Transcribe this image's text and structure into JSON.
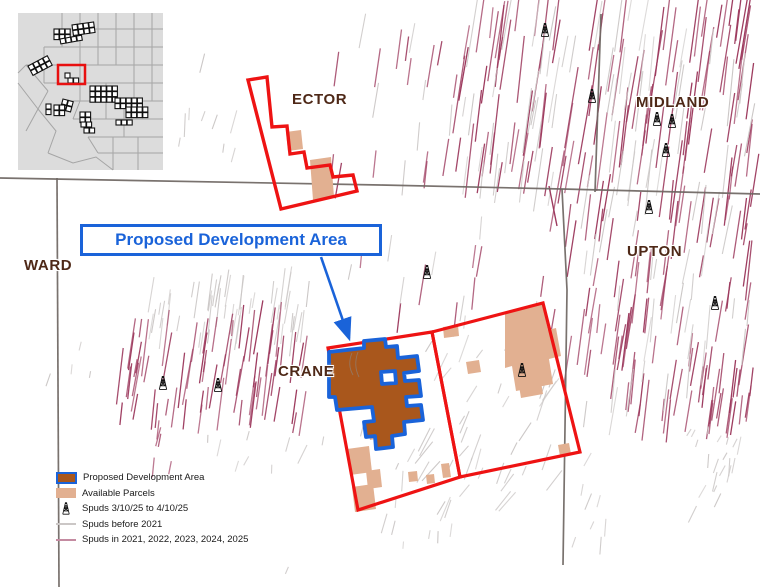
{
  "callout": {
    "label": "Proposed Development Area"
  },
  "county_labels": [
    {
      "id": "ector",
      "text": "ECTOR",
      "x": 292,
      "y": 91
    },
    {
      "id": "midland",
      "text": "MIDLAND",
      "x": 636,
      "y": 94
    },
    {
      "id": "upton",
      "text": "UPTON",
      "x": 627,
      "y": 243
    },
    {
      "id": "ward",
      "text": "WARD",
      "x": 24,
      "y": 257
    },
    {
      "id": "crane",
      "text": "CRANE",
      "x": 278,
      "y": 363
    }
  ],
  "legend": {
    "items": [
      {
        "swatch": "proposed",
        "label": "Proposed Development Area"
      },
      {
        "swatch": "parcel",
        "label": "Available Parcels"
      },
      {
        "swatch": "derrick",
        "label": "Spuds 3/10/25 to 4/10/25"
      },
      {
        "swatch": "line-gray",
        "label": "Spuds before 2021"
      },
      {
        "swatch": "line-pink",
        "label": "Spuds in 2021, 2022, 2023, 2024, 2025"
      }
    ]
  },
  "colors": {
    "red": "#ee1313",
    "blue": "#1a63d9",
    "brown": "#a9571c",
    "tan": "#e2b091",
    "maroon": "#9d3a5e",
    "gray_spud": "#cbc7c6",
    "county_line": "#6e6662",
    "label": "#4e2817",
    "inset_bg": "#dcdcdc",
    "inset_line": "#a5a5a5"
  },
  "map": {
    "county_lines": [
      [
        [
          0,
          178
        ],
        [
          380,
          185
        ],
        [
          562,
          189
        ],
        [
          760,
          194
        ]
      ],
      [
        [
          57,
          178
        ],
        [
          59,
          587
        ]
      ],
      [
        [
          562,
          189
        ],
        [
          567,
          290
        ],
        [
          563,
          565
        ]
      ],
      [
        [
          601,
          14
        ],
        [
          595,
          192
        ]
      ]
    ],
    "spud_clusters": [
      {
        "x": 455,
        "y": 0,
        "w": 300,
        "h": 192,
        "n": 105,
        "c": "maroon",
        "l": [
          30,
          85
        ],
        "tilt": 8,
        "tv": 4
      },
      {
        "x": 465,
        "y": 0,
        "w": 290,
        "h": 192,
        "n": 55,
        "c": "gray",
        "l": [
          25,
          75
        ],
        "tilt": 8,
        "tv": 6
      },
      {
        "x": 567,
        "y": 196,
        "w": 190,
        "h": 225,
        "n": 85,
        "c": "maroon",
        "l": [
          22,
          65
        ],
        "tilt": 8,
        "tv": 5
      },
      {
        "x": 585,
        "y": 200,
        "w": 172,
        "h": 215,
        "n": 34,
        "c": "gray",
        "l": [
          18,
          55
        ],
        "tilt": 8,
        "tv": 8
      },
      {
        "x": 700,
        "y": 372,
        "w": 52,
        "h": 48,
        "n": 14,
        "c": "maroon",
        "l": [
          25,
          45
        ],
        "tilt": 8,
        "tv": 4
      },
      {
        "x": 688,
        "y": 430,
        "w": 70,
        "h": 85,
        "n": 20,
        "c": "gray",
        "l": [
          7,
          20
        ],
        "tilt": 20,
        "tv": 40
      },
      {
        "x": 572,
        "y": 450,
        "w": 40,
        "h": 100,
        "n": 8,
        "c": "gray",
        "l": [
          7,
          18
        ],
        "tilt": 15,
        "tv": 30
      },
      {
        "x": 150,
        "y": 283,
        "w": 160,
        "h": 58,
        "n": 50,
        "c": "gray",
        "l": [
          12,
          42
        ],
        "tilt": 8,
        "tv": 5
      },
      {
        "x": 118,
        "y": 325,
        "w": 190,
        "h": 100,
        "n": 68,
        "c": "maroon",
        "l": [
          15,
          58
        ],
        "tilt": 8,
        "tv": 5
      },
      {
        "x": 130,
        "y": 425,
        "w": 60,
        "h": 50,
        "n": 5,
        "c": "maroon",
        "l": [
          10,
          22
        ],
        "tilt": 10,
        "tv": 10
      },
      {
        "x": 330,
        "y": 25,
        "w": 140,
        "h": 170,
        "n": 15,
        "c": "maroon",
        "l": [
          15,
          48
        ],
        "tilt": 8,
        "tv": 5
      },
      {
        "x": 335,
        "y": 30,
        "w": 150,
        "h": 165,
        "n": 10,
        "c": "gray",
        "l": [
          12,
          38
        ],
        "tilt": 8,
        "tv": 8
      },
      {
        "x": 340,
        "y": 200,
        "w": 215,
        "h": 125,
        "n": 9,
        "c": "maroon",
        "l": [
          15,
          45
        ],
        "tilt": 8,
        "tv": 6
      },
      {
        "x": 345,
        "y": 205,
        "w": 210,
        "h": 120,
        "n": 8,
        "c": "gray",
        "l": [
          12,
          35
        ],
        "tilt": 8,
        "tv": 8
      },
      {
        "x": 422,
        "y": 335,
        "w": 135,
        "h": 180,
        "n": 42,
        "c": "gray",
        "l": [
          10,
          32
        ],
        "tilt": 30,
        "tv": 25
      },
      {
        "x": 195,
        "y": 430,
        "w": 330,
        "h": 145,
        "n": 26,
        "c": "gray",
        "l": [
          7,
          22
        ],
        "tilt": 15,
        "tv": 30
      },
      {
        "x": 168,
        "y": 55,
        "w": 75,
        "h": 115,
        "n": 9,
        "c": "gray",
        "l": [
          8,
          24
        ],
        "tilt": 12,
        "tv": 20
      },
      {
        "x": 20,
        "y": 340,
        "w": 80,
        "h": 60,
        "n": 4,
        "c": "gray",
        "l": [
          6,
          16
        ],
        "tilt": 10,
        "tv": 20
      }
    ],
    "extra_lines": [
      {
        "x1": 533,
        "y1": 325,
        "x2": 536,
        "y2": 372,
        "c": "maroon",
        "w": 1.6
      },
      {
        "x1": 549,
        "y1": 186,
        "x2": 557,
        "y2": 226,
        "c": "maroon",
        "w": 1.4
      }
    ],
    "tan_parcels": [
      [
        [
          286,
          132
        ],
        [
          301,
          130
        ],
        [
          303,
          149
        ],
        [
          288,
          151
        ]
      ],
      [
        [
          310,
          160
        ],
        [
          331,
          157
        ],
        [
          334,
          197
        ],
        [
          313,
          200
        ]
      ],
      [
        [
          505,
          312
        ],
        [
          542,
          303
        ],
        [
          548,
          330
        ],
        [
          556,
          328
        ],
        [
          561,
          356
        ],
        [
          549,
          359
        ],
        [
          553,
          384
        ],
        [
          516,
          391
        ],
        [
          512,
          366
        ],
        [
          505,
          368
        ]
      ],
      [
        [
          443,
          327
        ],
        [
          458,
          325
        ],
        [
          459,
          336
        ],
        [
          444,
          338
        ]
      ],
      [
        [
          466,
          362
        ],
        [
          479,
          360
        ],
        [
          481,
          372
        ],
        [
          468,
          374
        ]
      ],
      [
        [
          518,
          380
        ],
        [
          540,
          376
        ],
        [
          543,
          394
        ],
        [
          521,
          398
        ]
      ],
      [
        [
          558,
          445
        ],
        [
          569,
          443
        ],
        [
          571,
          454
        ],
        [
          560,
          456
        ]
      ],
      [
        [
          398,
          386
        ],
        [
          413,
          384
        ],
        [
          415,
          397
        ],
        [
          400,
          399
        ]
      ],
      [
        [
          368,
          429
        ],
        [
          379,
          427
        ],
        [
          381,
          438
        ],
        [
          370,
          440
        ]
      ],
      [
        [
          347,
          449
        ],
        [
          369,
          446
        ],
        [
          372,
          472
        ],
        [
          350,
          475
        ]
      ],
      [
        [
          366,
          471
        ],
        [
          380,
          469
        ],
        [
          382,
          487
        ],
        [
          368,
          489
        ]
      ],
      [
        [
          352,
          487
        ],
        [
          373,
          484
        ],
        [
          376,
          509
        ],
        [
          355,
          512
        ]
      ],
      [
        [
          408,
          472
        ],
        [
          417,
          471
        ],
        [
          418,
          481
        ],
        [
          409,
          482
        ]
      ],
      [
        [
          426,
          475
        ],
        [
          434,
          474
        ],
        [
          435,
          483
        ],
        [
          427,
          484
        ]
      ],
      [
        [
          441,
          464
        ],
        [
          449,
          463
        ],
        [
          451,
          477
        ],
        [
          443,
          478
        ]
      ]
    ],
    "ector_outline": [
      [
        248,
        80
      ],
      [
        267,
        77
      ],
      [
        272,
        127
      ],
      [
        287,
        126
      ],
      [
        290,
        154
      ],
      [
        304,
        152
      ],
      [
        307,
        168
      ],
      [
        330,
        165
      ],
      [
        333,
        177
      ],
      [
        353,
        175
      ],
      [
        357,
        191
      ],
      [
        281,
        209
      ]
    ],
    "red_blocks": [
      [
        [
          328,
          348
        ],
        [
          432,
          332
        ],
        [
          460,
          477
        ],
        [
          358,
          510
        ]
      ],
      [
        [
          432,
          332
        ],
        [
          543,
          303
        ],
        [
          580,
          452
        ],
        [
          460,
          477
        ]
      ]
    ],
    "proposed_path": "M329,352 L364,348 L364,341 L385,339 L386,347 L397,346 L398,358 L417,356 L419,371 L404,373 L405,381 L419,380 L421,396 L406,397 L407,406 L421,405 L423,420 L404,422 L405,434 L392,436 L393,447 L376,449 L375,436 L366,437 L364,422 L374,421 L372,407 L337,410 L335,397 L329,397 Z M381,372 L395,371 L396,383 L382,384 Z",
    "road_marks": [
      "M352,353 C349,360 349,368 353,375",
      "M358,352 C355,360 355,369 359,377"
    ],
    "derricks": [
      {
        "x": 545,
        "y": 30
      },
      {
        "x": 592,
        "y": 96
      },
      {
        "x": 657,
        "y": 119
      },
      {
        "x": 672,
        "y": 121
      },
      {
        "x": 666,
        "y": 150
      },
      {
        "x": 649,
        "y": 207
      },
      {
        "x": 427,
        "y": 272
      },
      {
        "x": 715,
        "y": 303
      },
      {
        "x": 522,
        "y": 370
      },
      {
        "x": 163,
        "y": 383
      },
      {
        "x": 218,
        "y": 385
      }
    ],
    "arrow": {
      "x1": 321,
      "y1": 257,
      "x2": 349,
      "y2": 338
    },
    "inset": {
      "x": 18,
      "y": 13,
      "w": 145,
      "h": 157,
      "paths": [
        "M44,0 V34",
        "M62,0 V52",
        "M80,0 V52",
        "M98,0 V52",
        "M116,0 V52",
        "M134,0 V52",
        "M44,16 H145",
        "M26,34 H145",
        "M8,52 H145",
        "M26,70 H145",
        "M44,88 H145",
        "M55,106 H145",
        "M70,124 H145",
        "M80,140 H145",
        "M26,34 V70",
        "M8,52 L0,60",
        "M0,70 L20,96 L8,118",
        "M8,52 L30,78",
        "M30,78 L20,96",
        "M20,96 L38,118 L30,140",
        "M30,140 L55,150 L78,144 L95,157",
        "M62,52 V88",
        "M88,70 V106",
        "M116,52 V88",
        "M134,52 V88",
        "M106,88 V124",
        "M62,88 L55,106",
        "M95,124 V157",
        "M120,124 V157",
        "M70,124 L80,140"
      ],
      "clusters": [
        {
          "x": 36,
          "y": 16,
          "c": 3,
          "r": 2,
          "rot": 0
        },
        {
          "x": 54,
          "y": 12,
          "c": 4,
          "r": 2,
          "rot": -8
        },
        {
          "x": 42,
          "y": 26,
          "c": 4,
          "r": 1,
          "rot": -10
        },
        {
          "x": 10,
          "y": 53,
          "c": 4,
          "r": 2,
          "rot": -28
        },
        {
          "x": 47,
          "y": 60,
          "c": 1,
          "r": 1,
          "rot": 0
        },
        {
          "x": 50,
          "y": 65,
          "c": 2,
          "r": 1,
          "rot": 0
        },
        {
          "x": 72,
          "y": 73,
          "c": 5,
          "r": 3,
          "rot": 0
        },
        {
          "x": 97,
          "y": 85,
          "c": 5,
          "r": 2,
          "rot": 0
        },
        {
          "x": 108,
          "y": 94,
          "c": 4,
          "r": 2,
          "rot": 0
        },
        {
          "x": 45,
          "y": 86,
          "c": 2,
          "r": 2,
          "rot": 15
        },
        {
          "x": 36,
          "y": 92,
          "c": 2,
          "r": 2,
          "rot": 0
        },
        {
          "x": 28,
          "y": 91,
          "c": 1,
          "r": 2,
          "rot": 0
        },
        {
          "x": 62,
          "y": 99,
          "c": 2,
          "r": 2,
          "rot": 0
        },
        {
          "x": 98,
          "y": 107,
          "c": 3,
          "r": 1,
          "rot": 0
        },
        {
          "x": 63,
          "y": 109,
          "c": 2,
          "r": 1,
          "rot": 0
        },
        {
          "x": 66,
          "y": 115,
          "c": 2,
          "r": 1,
          "rot": 0
        }
      ],
      "highlight": {
        "x": 40,
        "y": 52,
        "w": 27,
        "h": 19
      }
    }
  }
}
